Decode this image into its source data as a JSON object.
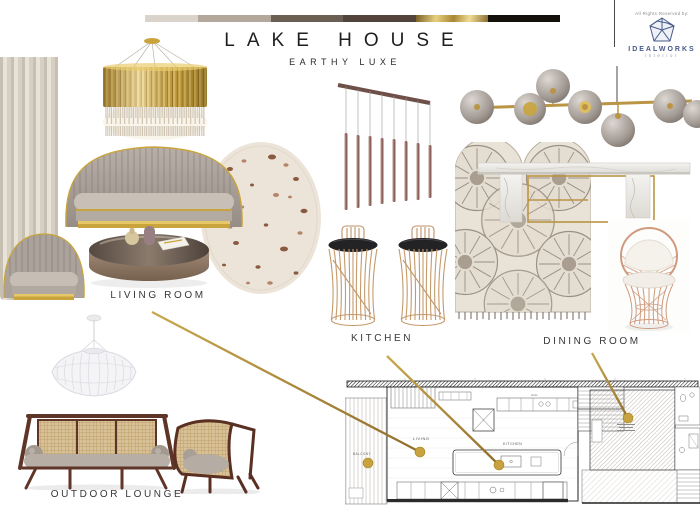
{
  "header": {
    "title": "LAKE HOUSE",
    "subtitle": "EARTHY LUXE",
    "palette": [
      {
        "name": "cream",
        "css": "#d9d3cc",
        "w": 53
      },
      {
        "name": "taupe",
        "css": "#b3a89b",
        "w": 73
      },
      {
        "name": "umber",
        "css": "#6b5f53",
        "w": 72
      },
      {
        "name": "dark-brown",
        "css": "#52443b",
        "w": 73
      },
      {
        "name": "gold",
        "css": "linear-gradient(100deg,#7a5f26 0%,#e8cf7e 28%,#a98733 52%,#f0dc96 74%,#8a6d2f 100%)",
        "w": 72
      },
      {
        "name": "black",
        "css": "#14100b",
        "w": 72
      }
    ]
  },
  "branding": {
    "rights_text": "All Rights Reserved by:",
    "logo_name": "IDEALWORKS",
    "logo_tagline": "interior",
    "logo_color": "#47598a"
  },
  "sections": {
    "living_room_label": "LIVING ROOM",
    "kitchen_label": "KITCHEN",
    "dining_room_label": "DINING ROOM",
    "outdoor_lounge_label": "OUTDOOR LOUNGE"
  },
  "floor_plan": {
    "room_labels": {
      "balcony": "BALCONY",
      "living": "LIVING",
      "kitchen": "KITCHEN",
      "hall": "HALL"
    }
  },
  "colors": {
    "accent_gold": "#b3903d",
    "dot_gold": "#c7a23f",
    "label_text": "#383838"
  }
}
